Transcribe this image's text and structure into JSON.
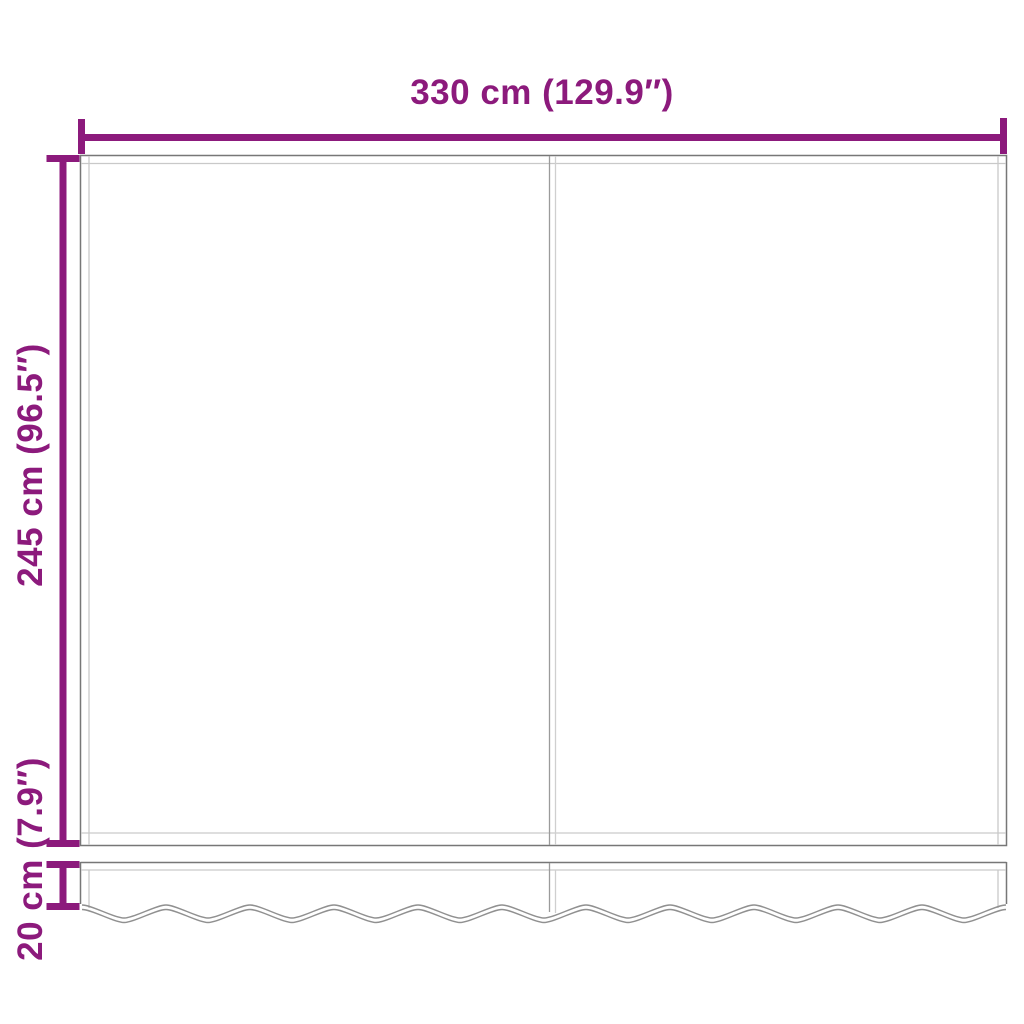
{
  "diagram": {
    "kind": "dimension-diagram",
    "labels": {
      "width": "330 cm (129.9″)",
      "height": "245 cm (96.5″)",
      "valance_height": "20 cm (7.9″)"
    },
    "measurements": {
      "width": {
        "cm": 330,
        "inches": 129.9
      },
      "height": {
        "cm": 245,
        "inches": 96.5
      },
      "valance_height": {
        "cm": 20,
        "inches": 7.9
      }
    },
    "units": [
      "cm",
      "in"
    ],
    "colors": {
      "accent": "#8C1A7C",
      "outline": "#777777",
      "inner_line": "#C9C9C9",
      "seam_dark": "#9B9B9B",
      "seam_light": "#CFCFCF",
      "wave": "#909090",
      "background": "#FFFFFF"
    }
  }
}
